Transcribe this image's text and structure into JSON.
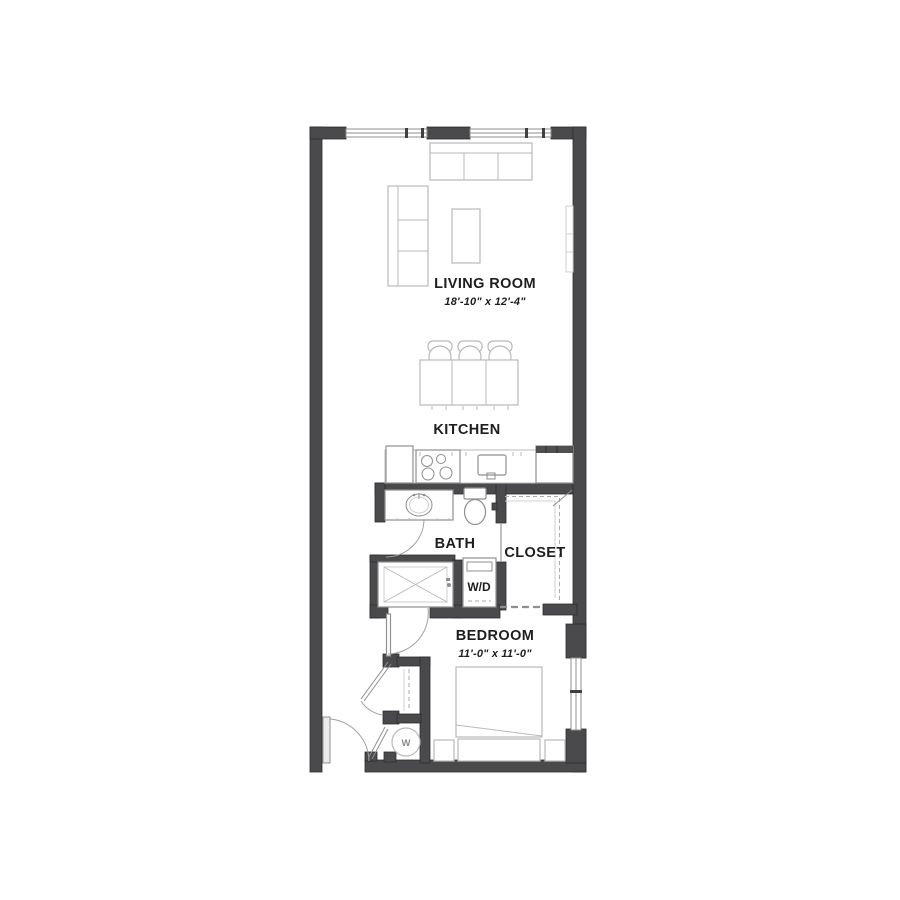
{
  "colors": {
    "bg": "#ffffff",
    "wall": "#4a4a4c",
    "wall-edge": "#2e2e30",
    "line-light": "#b9b9b9",
    "line-mid": "#8f8f8f",
    "text": "#1e1e1e"
  },
  "labels": {
    "living_room": "LIVING ROOM",
    "living_room_dims": "18'-10\" x 12'-4\"",
    "kitchen": "KITCHEN",
    "bath": "BATH",
    "closet": "CLOSET",
    "wd": "W/D",
    "bedroom": "BEDROOM",
    "bedroom_dims": "11'-0\" x 11'-0\"",
    "water_heater": "W"
  }
}
